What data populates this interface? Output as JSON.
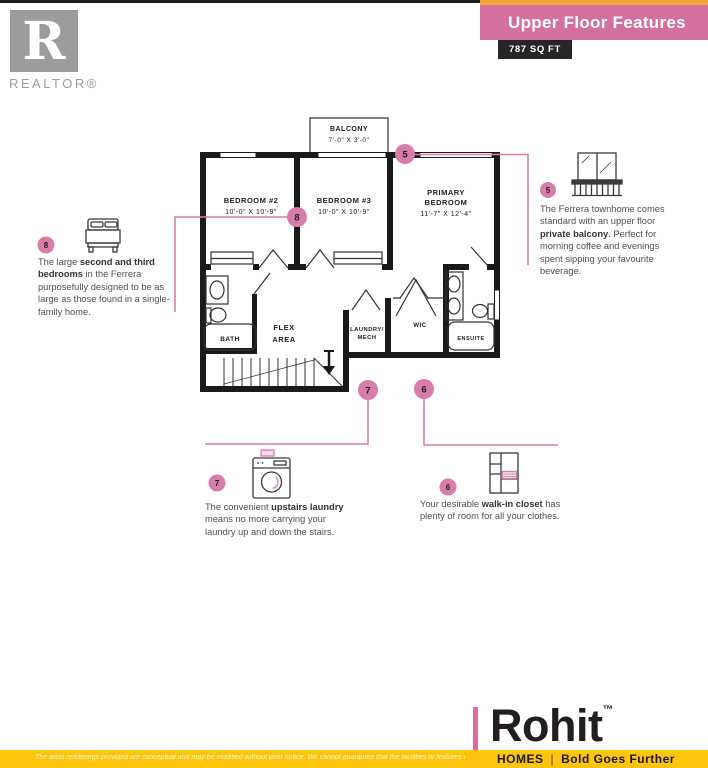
{
  "header": {
    "title": "Upper Floor Features",
    "sqft_badge": "787 SQ FT"
  },
  "realtor_logo": {
    "letter": "R",
    "label": "REALTOR®"
  },
  "floor_plan": {
    "balcony_name": "BALCONY",
    "balcony_dims": "7'-0\" X 3'-0\"",
    "bedroom2_name": "BEDROOM #2",
    "bedroom2_dims": "10'-0\" X 10'-9\"",
    "bedroom3_name": "BEDROOM #3",
    "bedroom3_dims": "10'-0\" X 10'-9\"",
    "primary_name1": "PRIMARY",
    "primary_name2": "BEDROOM",
    "primary_dims": "11'-7\" X 12'-4\"",
    "bath": "BATH",
    "flex1": "FLEX",
    "flex2": "AREA",
    "laundry1": "LAUNDRY/",
    "laundry2": "MECH",
    "wic": "WIC",
    "ensuite": "ENSUITE"
  },
  "callouts": {
    "c5": {
      "number": "5",
      "pre": "The Ferrera townhome comes standard with an upper floor ",
      "bold": "private balcony",
      "post": ". Perfect for morning coffee and evenings spent sipping your favourite beverage."
    },
    "c8": {
      "number": "8",
      "pre": "The large ",
      "bold": "second and third bedrooms",
      "post": " in the Ferrera purposefully designed to be as large as those found in a single-family home."
    },
    "c7": {
      "number": "7",
      "pre": "The convenient ",
      "bold": "upstairs laundry",
      "post": " means no more carrying your laundry up and down the stairs."
    },
    "c6": {
      "number": "6",
      "pre": "Your desirable ",
      "bold": "walk-in closet",
      "post": " has plenty of room for all your clothes."
    }
  },
  "footer": {
    "brand": "Rohit",
    "tm": "™",
    "homes": "HOMES",
    "divider": "|",
    "tagline": "Bold Goes Further",
    "disclaimer": "The artist renderings provided are conceptual and may be modified without prior notice. We cannot guarantee that the facilities or features depicted"
  },
  "colors": {
    "pink_banner": "#D4709F",
    "pink_accent": "#D87CA9",
    "orange": "#F3A73B",
    "yellow": "#FFC40D",
    "wall": "#1A1A1A"
  }
}
